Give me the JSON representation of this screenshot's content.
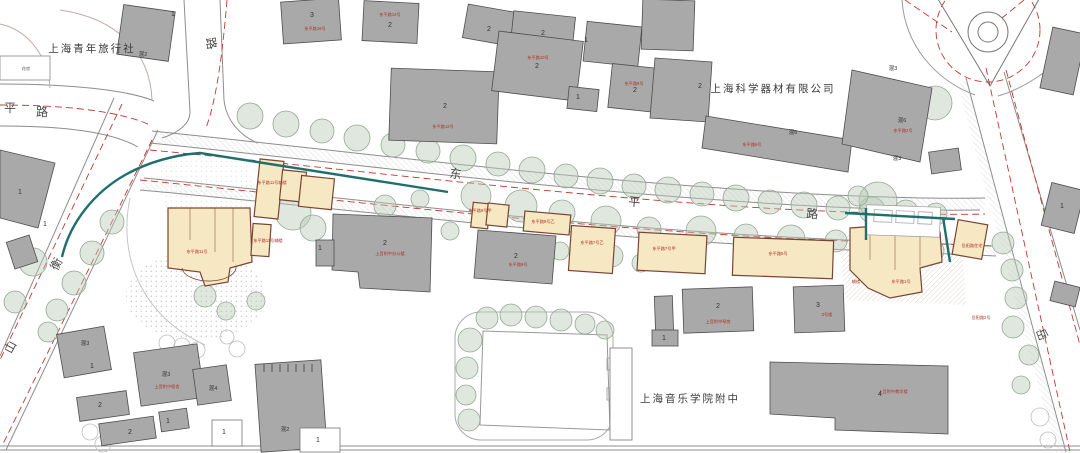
{
  "places": {
    "youth_hostel": "上海青年旅行社",
    "science_co": "上海科学器材有限公司",
    "music_school": "上海音乐学院附中",
    "garden_hut": "花房"
  },
  "road_names": {
    "dongping_1": "东",
    "dongping_2": "平",
    "dongping_3": "路",
    "hengshan_1": "衡",
    "hengshan_2": "山",
    "yueyang_1": "岳",
    "west_partial_1": "平",
    "west_partial_2": "路",
    "north_partial_1": "路"
  },
  "building_numbers": {
    "n1": "1",
    "n2": "2",
    "n3": "3",
    "n4": "4"
  },
  "structure_labels": {
    "hun2": "混2",
    "hun3": "混3",
    "hun4": "混4",
    "hun6": "混6"
  },
  "red_labels": {
    "r1": "东平路11号",
    "r2": "东平路11号辅楼",
    "r3": "东平路9号甲",
    "r4": "东平路9号乙",
    "r5": "东平路9号",
    "r6": "东平路7号乙",
    "r7": "东平路7号甲",
    "r8": "东平路5号",
    "r9": "东平路1号",
    "r10": "岳阳路住宅",
    "r11": "岳阳路2号",
    "r12": "上音附中办公楼",
    "r13": "东平路14号",
    "r14": "东平路12号",
    "r15": "东平路10号",
    "r16": "东平路8号",
    "r17": "东平路16号",
    "r18": "东平路6号",
    "r19": "东平路2号",
    "r20": "上音附中宿舍",
    "r21": "上音附中教学楼",
    "r22": "上音附中琴房",
    "r23": "3号楼",
    "r24": "辅楼"
  },
  "colors": {
    "heritage_fill": "#f6e8c2",
    "heritage_outline": "#7a4434",
    "gray_building": "#a9a9a9",
    "tree": "#b9c9b9",
    "site_boundary_teal": "#1e6f6d",
    "regulation_red_dash": "#c0392b",
    "red_label": "#b03028"
  }
}
